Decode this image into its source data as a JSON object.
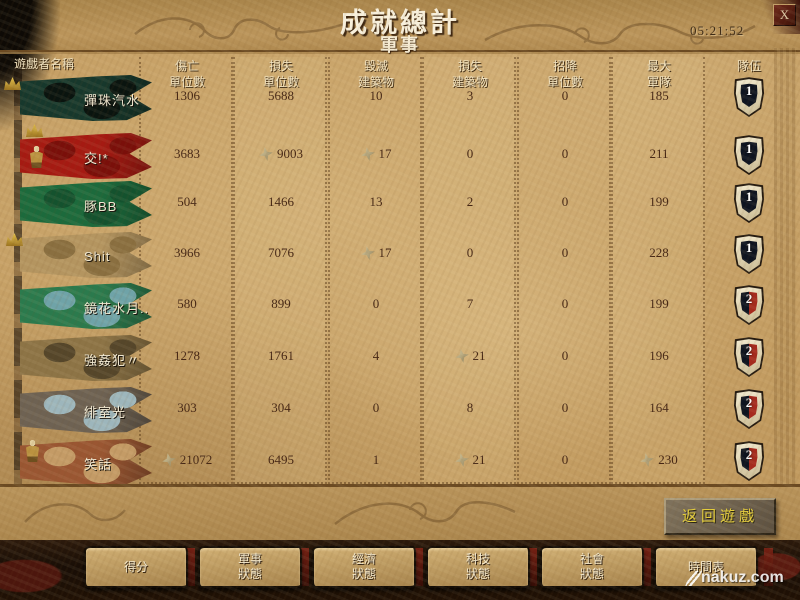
{
  "window": {
    "title": "成就總計",
    "subtitle": "軍事",
    "elapsed_time": "05:21:52",
    "close_label": "X"
  },
  "table": {
    "player_header": "遊戲者名稱",
    "team_header": "隊伍",
    "stat_headers": [
      [
        "傷亡",
        "單位數"
      ],
      [
        "損失",
        "單位數"
      ],
      [
        "毀滅",
        "建築物"
      ],
      [
        "損失",
        "建築物"
      ],
      [
        "招降",
        "單位數"
      ],
      [
        "最大",
        "軍隊"
      ]
    ],
    "rows": [
      {
        "name": "彈珠汽水",
        "values": [
          "1306",
          "5688",
          "10",
          "3",
          "0",
          "185"
        ],
        "starred": [
          false,
          false,
          false,
          false,
          false,
          false
        ],
        "team": "1",
        "flag": {
          "c1": "#17382c",
          "c2": "#0a140f"
        },
        "badges": [
          "crown"
        ]
      },
      {
        "name": "交!*",
        "values": [
          "3683",
          "9003",
          "17",
          "0",
          "0",
          "211"
        ],
        "starred": [
          false,
          true,
          true,
          false,
          false,
          false
        ],
        "team": "1",
        "flag": {
          "c1": "#a51a12",
          "c2": "#7a0f0a"
        },
        "badges": [
          "crown",
          "unit"
        ]
      },
      {
        "name": "豚BB",
        "values": [
          "504",
          "1466",
          "13",
          "2",
          "0",
          "199"
        ],
        "starred": [
          false,
          false,
          false,
          false,
          false,
          false
        ],
        "team": "1",
        "flag": {
          "c1": "#1c6a3c",
          "c2": "#14522e"
        },
        "badges": []
      },
      {
        "name": "Shit",
        "values": [
          "3966",
          "7076",
          "17",
          "0",
          "0",
          "228"
        ],
        "starred": [
          false,
          false,
          true,
          false,
          false,
          false
        ],
        "team": "1",
        "flag": {
          "c1": "#b49560",
          "c2": "#8a6f40"
        },
        "badges": [
          "crown"
        ]
      },
      {
        "name": "鏡花水月..",
        "values": [
          "580",
          "899",
          "0",
          "7",
          "0",
          "199"
        ],
        "starred": [
          false,
          false,
          false,
          false,
          false,
          false
        ],
        "team": "2",
        "flag": {
          "c1": "#2b7a4d",
          "c2": "#6fa3a8"
        },
        "badges": []
      },
      {
        "name": "強姦犯〃",
        "values": [
          "1278",
          "1761",
          "4",
          "21",
          "0",
          "196"
        ],
        "starred": [
          false,
          false,
          false,
          true,
          false,
          false
        ],
        "team": "2",
        "flag": {
          "c1": "#8d7446",
          "c2": "#55462a"
        },
        "badges": []
      },
      {
        "name": "緋室光",
        "values": [
          "303",
          "304",
          "0",
          "8",
          "0",
          "164"
        ],
        "starred": [
          false,
          false,
          false,
          false,
          false,
          false
        ],
        "team": "2",
        "flag": {
          "c1": "#6e6253",
          "c2": "#9db6bc"
        },
        "badges": []
      },
      {
        "name": "笑話",
        "values": [
          "21072",
          "6495",
          "1",
          "21",
          "0",
          "230"
        ],
        "starred": [
          true,
          false,
          false,
          true,
          false,
          true
        ],
        "team": "2",
        "flag": {
          "c1": "#9a5632",
          "c2": "#c49b66"
        },
        "badges": [
          "unit"
        ]
      }
    ]
  },
  "colors": {
    "team1_shield": "#0e1420",
    "team2_shield_right": "#a62a1e",
    "button_text": "#e6cf3a",
    "parchment": "#c19a5f"
  },
  "footer": {
    "back_button": "返回遊戲",
    "tabs": [
      {
        "label": "得分",
        "lines": [
          "得分"
        ]
      },
      {
        "label": "軍事狀態",
        "lines": [
          "軍事",
          "狀態"
        ]
      },
      {
        "label": "經濟狀態",
        "lines": [
          "經濟",
          "狀態"
        ]
      },
      {
        "label": "科技狀態",
        "lines": [
          "科技",
          "狀態"
        ]
      },
      {
        "label": "社會狀態",
        "lines": [
          "社會",
          "狀態"
        ]
      },
      {
        "label": "時間表",
        "lines": [
          "時間表"
        ]
      }
    ],
    "watermark": "nakuz.com"
  }
}
